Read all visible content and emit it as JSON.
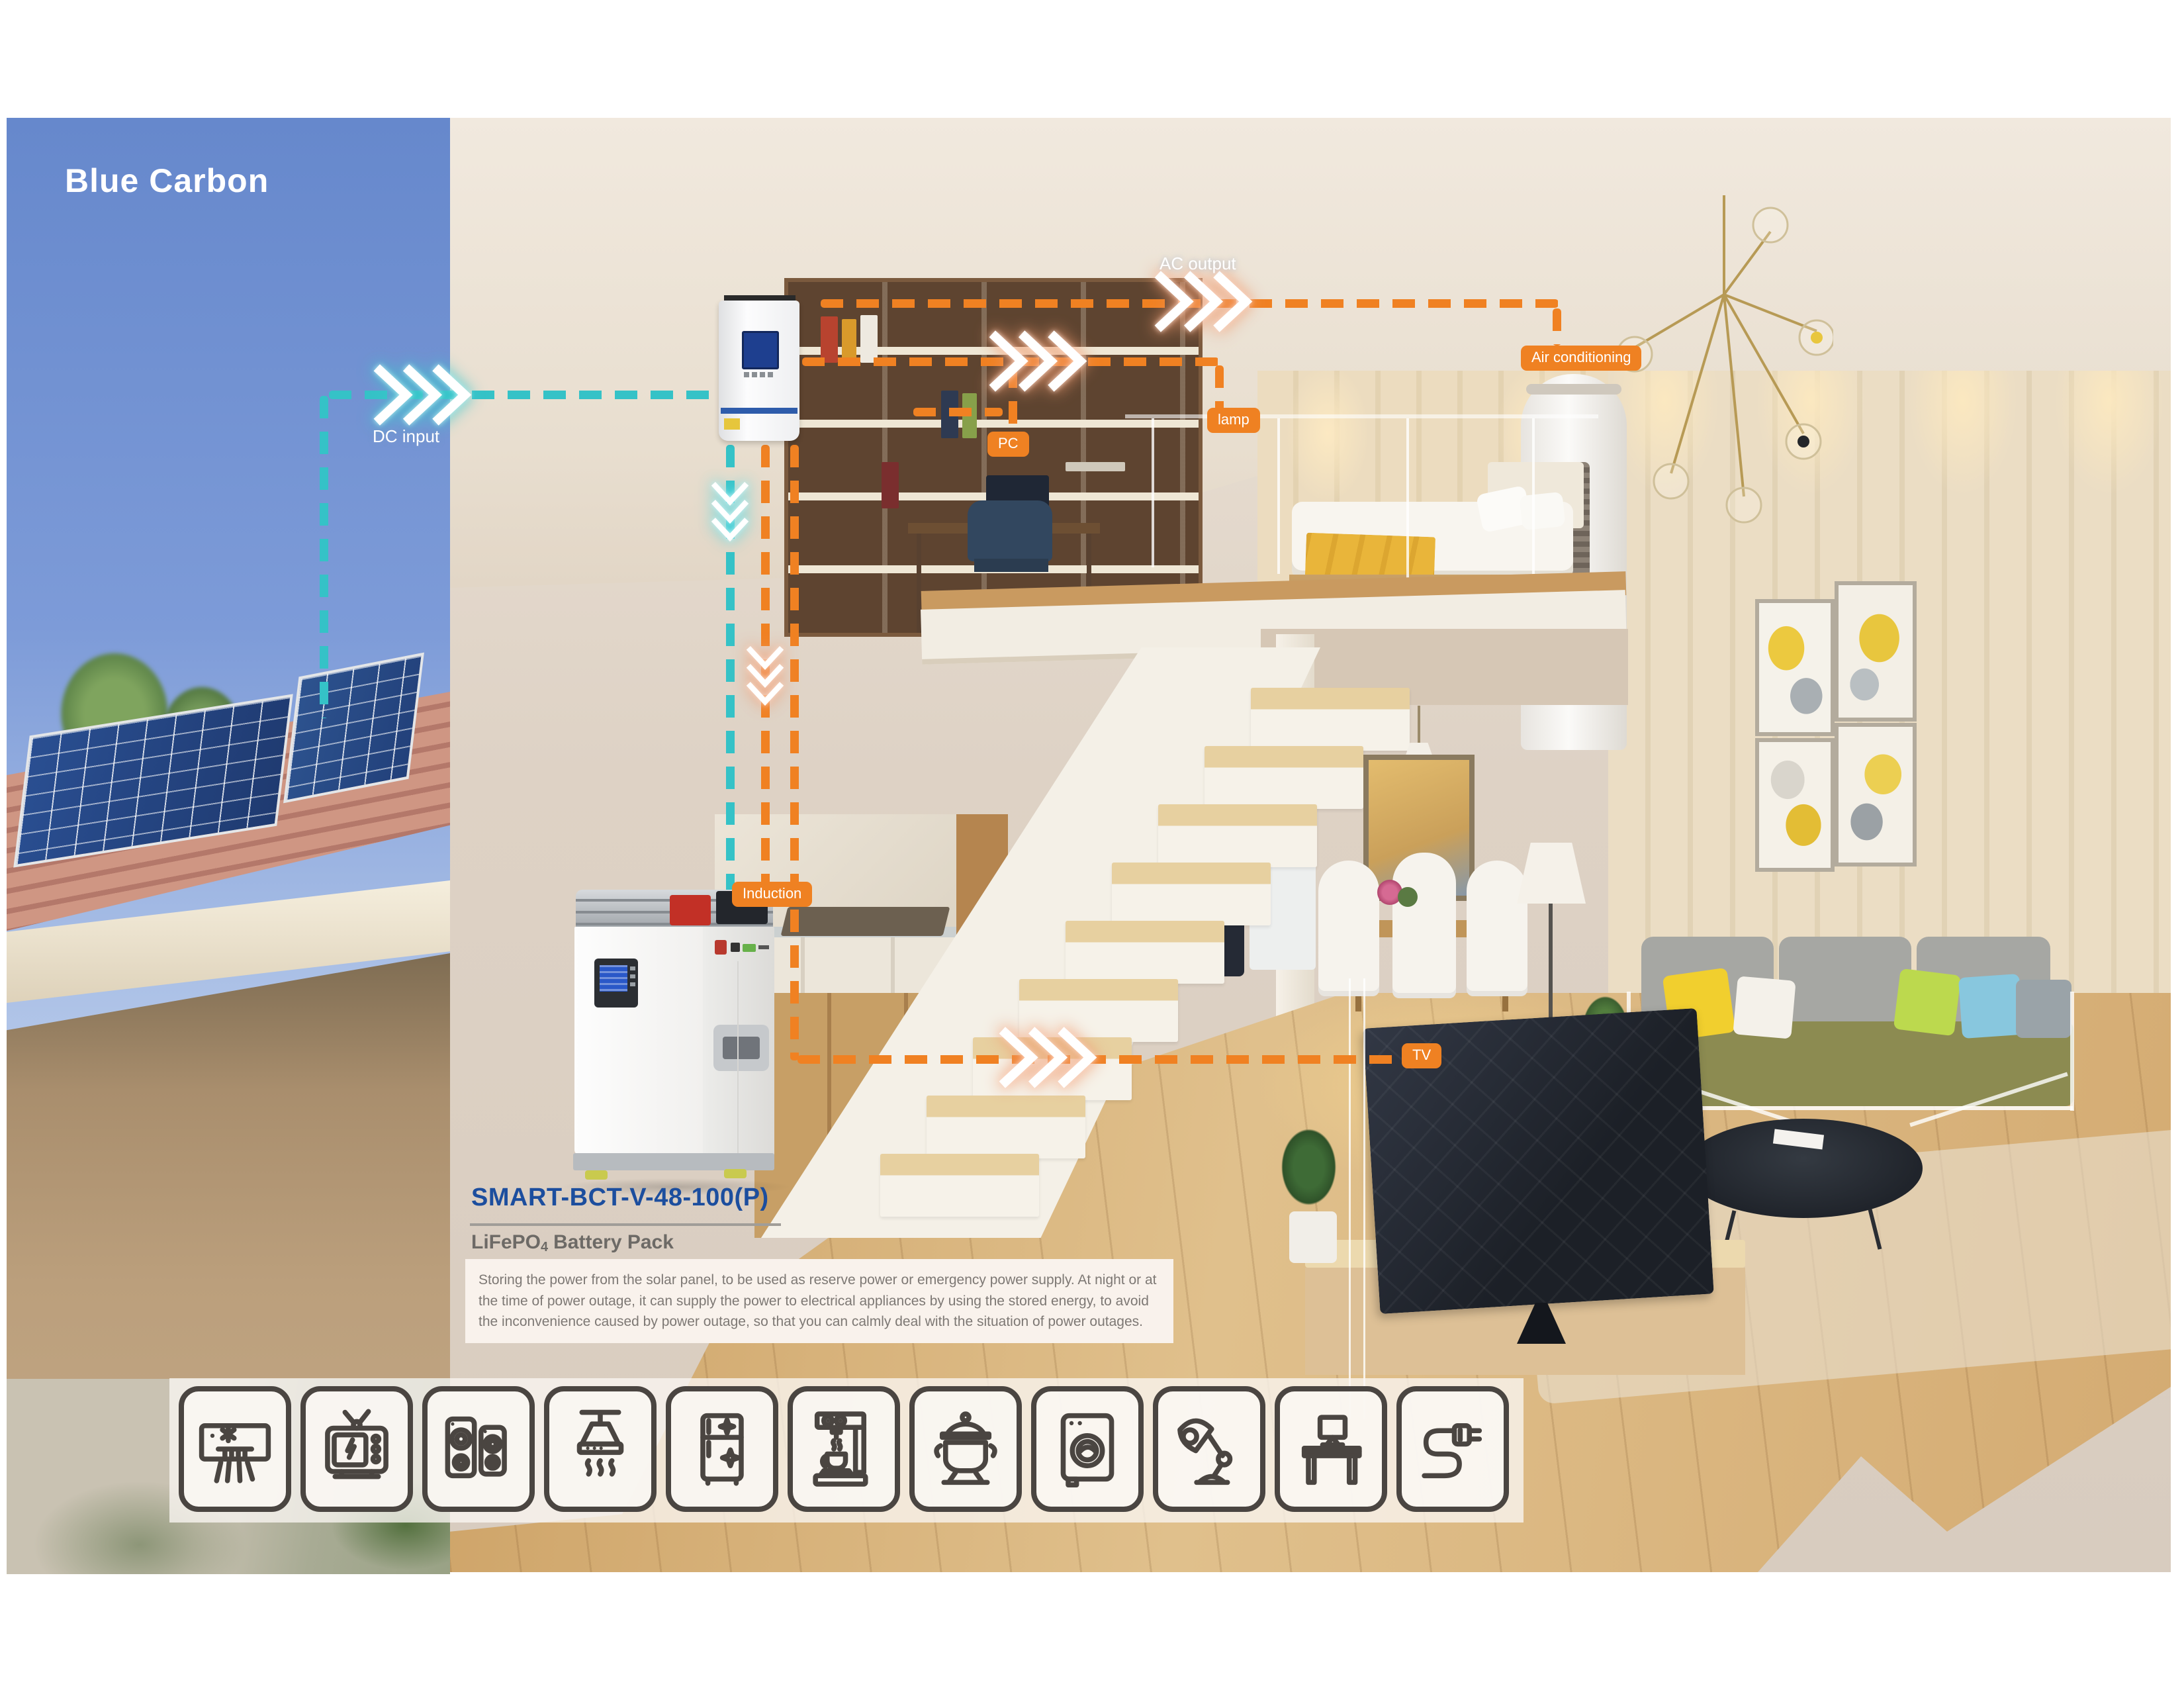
{
  "brand": {
    "logo_text": "Blue Carbon"
  },
  "flow_labels": {
    "dc_input": "DC input",
    "ac_output": "AC output",
    "pc": "PC",
    "lamp": "lamp",
    "air_conditioning": "Air conditioning",
    "induction": "Induction",
    "tv": "TV"
  },
  "product": {
    "model": "SMART-BCT-V-48-100(P)",
    "chemistry_prefix": "LiFePO",
    "chemistry_subscript": "4",
    "chemistry_suffix": "Battery Pack",
    "description": "Storing the power from the solar panel, to be used as reserve power or emergency power supply. At night or at the time of power outage, it can supply the power to electrical appliances by using the stored energy, to avoid the inconvenience caused by power outage, so that you can calmly deal with the situation of power outages."
  },
  "appliance_icons": [
    "air-conditioner-icon",
    "tv-icon",
    "speakers-icon",
    "range-hood-icon",
    "refrigerator-icon",
    "coffee-machine-icon",
    "cooking-pot-icon",
    "washing-machine-icon",
    "desk-lamp-icon",
    "computer-desk-icon",
    "power-plug-icon"
  ],
  "colors": {
    "dc_flow": "#35C2C7",
    "ac_flow": "#F08122",
    "label_badge": "#EF8122",
    "model_title": "#1C4E9E",
    "subtitle_gray": "#6D6A66",
    "icon_stroke": "#4A4541"
  }
}
